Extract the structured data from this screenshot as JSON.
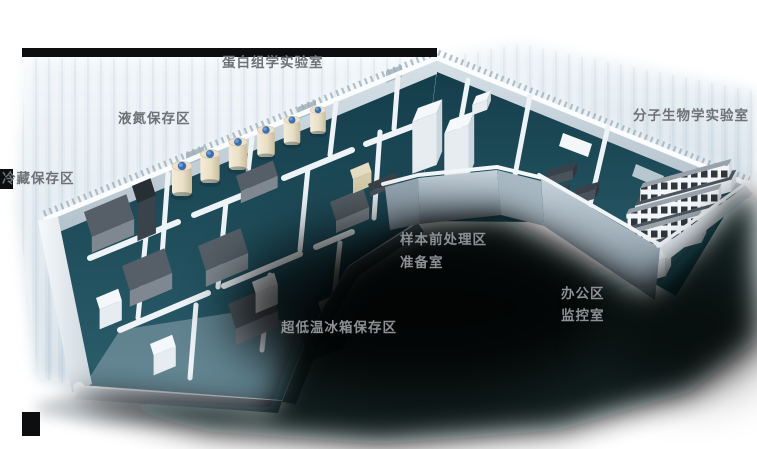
{
  "scene": {
    "description_labels": "3D laboratory floor plan area labels"
  },
  "labels": {
    "proteomics_lab": "蛋白组学实验室",
    "liquid_nitrogen_area": "液氮保存区",
    "cold_storage_area": "冷藏保存区",
    "molecular_biology_lab": "分子生物学实验室",
    "sample_pretreatment_area": "样本前处理区",
    "preparation_room": "准备室",
    "office_area": "办公区",
    "monitoring_room": "监控室",
    "ultralow_freezer_area": "超低温冰箱保存区"
  },
  "colors": {
    "label_on_light": "#6e7276",
    "label_on_dark": "#8d9194",
    "floor_teal_dark": "#153e4b",
    "floor_teal_light": "#2a5d6b",
    "wall_white": "#eef3f7",
    "wall_shade": "#c3cfd8",
    "shadow_black": "#05080a",
    "halo_blue": "#cfdce6",
    "tank_body": "#ece2c8",
    "tank_body_shade": "#cfc3a2",
    "tank_cap": "#3a6fb5",
    "freezer_top": "#565f67",
    "freezer_front": "#7f8890",
    "freezer_side": "#6b747c",
    "rack_top": "#272e34",
    "rack_front": "#3a434b",
    "rack_side": "#313a42",
    "cabinet_top": "#f5f8fa",
    "cabinet_front": "#e6ecf0",
    "cabinet_side": "#ccd6dd",
    "bench_counter": "#4d565e",
    "bench_front": "#e8edf1",
    "bench_side": "#d3dbe1",
    "shelf_top": "#99a2aa",
    "shelf_front": "#f3f6f8",
    "shelf_window": "#2f363c",
    "desk_top": "#39424a",
    "desk_front": "#4a535b",
    "desk_side": "#2f383f",
    "cream_top": "#e7ddc2",
    "cream_front": "#d9cfae",
    "cream_side": "#c9bf9e"
  }
}
